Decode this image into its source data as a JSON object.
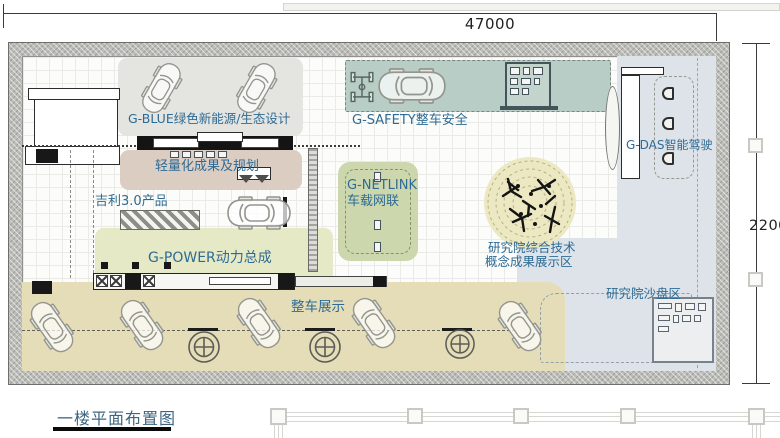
{
  "dimensions": {
    "width": "47000",
    "height": "22000"
  },
  "title": "一楼平面布置图",
  "zones": {
    "g_blue": {
      "label": "G-BLUE绿色新能源/生态设计",
      "color": "#e4e4e1"
    },
    "g_safety": {
      "label": "G-SAFETY整车安全",
      "color": "#b7cdc5"
    },
    "g_das": {
      "label": "G-DAS智能驾驶",
      "color": "#dde3e9"
    },
    "lightweight": {
      "label": "轻量化成果及规划",
      "color": "#dccdc3"
    },
    "geely_3_0": {
      "label": "吉利3.0产品"
    },
    "g_netlink": {
      "label_en": "G-NETLINK",
      "label_cn": "车载网联",
      "color": "#cdd7ae"
    },
    "g_power": {
      "label": "G-POWER动力总成",
      "color": "#e6e9c5"
    },
    "vehicle_display": {
      "label": "整车展示",
      "color": "#e4ddb7"
    },
    "research_concept": {
      "line1": "研究院综合技术",
      "line2": "概念成果展示区",
      "color": "#ece8c1"
    },
    "research_sandbox": {
      "label": "研究院沙盘区",
      "color": "#dde3e9"
    }
  },
  "colors": {
    "label_text": "#2e6b94",
    "title_text": "#3d6580",
    "wall": "#bcbcb8"
  }
}
